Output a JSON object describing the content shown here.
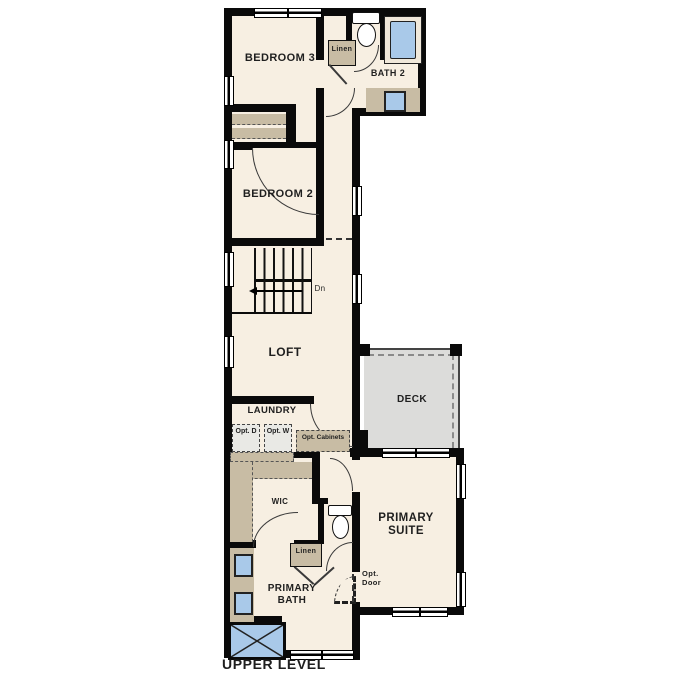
{
  "title": "UPPER LEVEL",
  "colors": {
    "wall": "#000000",
    "interior_fill": "#f7efe2",
    "casework_tan": "#c8bca4",
    "fixture_blue": "#a9c9e9",
    "deck_gray": "#dcdcda",
    "optional_fill": "#e9e9e5",
    "text": "#1f1f1f",
    "background": "#ffffff"
  },
  "rooms": {
    "bedroom3": "BEDROOM 3",
    "bath2": "BATH 2",
    "bedroom2": "BEDROOM 2",
    "loft": "LOFT",
    "laundry": "LAUNDRY",
    "wic": "WIC",
    "primary_suite": "PRIMARY SUITE",
    "primary_bath": "PRIMARY BATH",
    "deck": "DECK"
  },
  "annotations": {
    "linen_upper": "Linen",
    "linen_lower": "Linen",
    "stairs_down": "Dn",
    "opt_dryer": "Opt. D",
    "opt_washer": "Opt. W",
    "opt_cabinets": "Opt. Cabinets",
    "opt_door": "Opt. Door"
  }
}
